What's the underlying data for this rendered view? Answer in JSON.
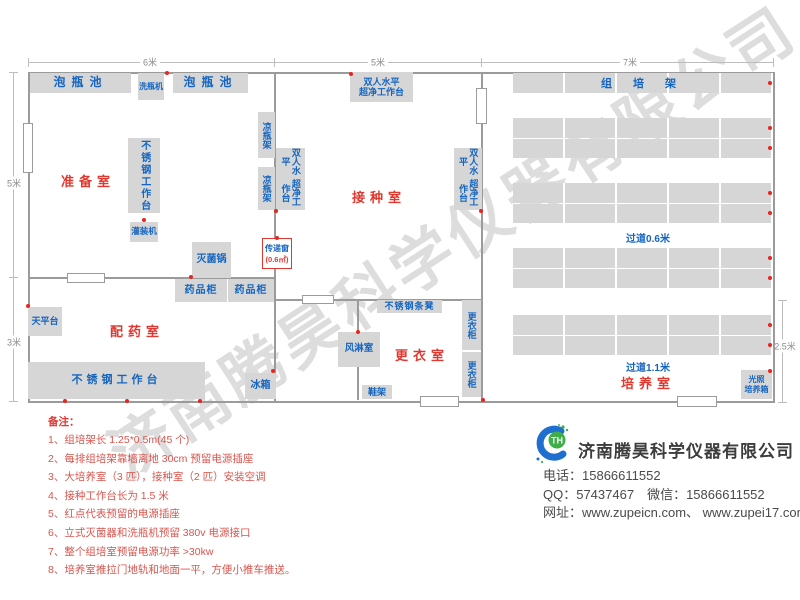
{
  "watermark": "济南腾昊科学仪器有限公司",
  "plan": {
    "dim": {
      "top_left": "6米",
      "top_mid": "5米",
      "top_right": "7米",
      "left_top": "5米",
      "left_bottom": "3米",
      "right": "2.5米"
    },
    "rooms": {
      "prep": "准备室",
      "dispense": "配药室",
      "inoculate": "接种室",
      "change": "更衣室",
      "culture": "培养室"
    },
    "eq": {
      "soak_pool": "泡瓶池",
      "bottle_washer": "洗瓶机",
      "cool_rack": "凉瓶架",
      "steel_bench": "不锈钢工作台",
      "filler": "灌装机",
      "sterilizer": "灭菌锅",
      "medicine_cabinet": "药品柜",
      "balance_table": "天平台",
      "fridge": "冰箱",
      "pass_window": "传递窗",
      "pass_window_area": "(0.6㎡)",
      "bench_line1": "双人水平",
      "bench_line2": "超净工作台",
      "air_shower": "风淋室",
      "locker": "更衣柜",
      "shoe_rack": "鞋架",
      "steel_stool": "不锈钢条凳",
      "culture_rack": "组 培 架",
      "light_incubator_line1": "光照",
      "light_incubator_line2": "培养箱"
    },
    "aisle": {
      "narrow": "过道0.6米",
      "wide": "过道1.1米"
    }
  },
  "notes": {
    "title": "备注：",
    "items": [
      "1、组培架长 1.25*0.5m(45 个)",
      "2、每排组培架靠墙离地 30cm 预留电源插座",
      "3、大培养室（3 匹），接种室（2 匹）安装空调",
      "4、接种工作台长为 1.5 米",
      "5、红点代表预留的电源插座",
      "6、立式灭菌器和洗瓶机预留 380v 电源接口",
      "7、整个组培室预留电源功率 >30kw",
      "8、培养室推拉门地轨和地面一平，方便小推车推送。"
    ]
  },
  "company": {
    "logo_text": "TH",
    "name": "济南腾昊科学仪器有限公司",
    "phone": "电话：15866611552",
    "qq_wechat": "QQ：57437467　微信：15866611552",
    "website": "网址：www.zupeicn.com、 www.zupei17.com"
  },
  "colors": {
    "accent_blue": "#1565c0",
    "accent_red": "#e0382f",
    "box_grey": "#d6d6d6",
    "wall_grey": "#9b9b9b",
    "outlet_dot_red": "#e8261f"
  }
}
